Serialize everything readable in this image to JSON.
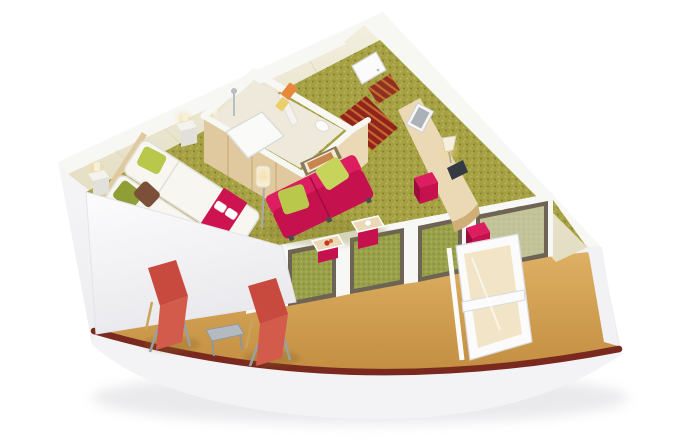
{
  "scene": {
    "kind": "isometric-3d-cutaway-floorplan",
    "description": "3D cutaway rendering of a wedge-shaped ship balcony suite on a white background: bedroom with twin beds, enclosed bathroom, entry hall with striped red runner, living area with magenta sofa and desk, and a curved private balcony with sun loungers",
    "rooms": [
      {
        "name": "bedroom",
        "items": [
          "twin-beds",
          "magenta-bed-runner",
          "folded-towels",
          "olive-pillow",
          "brown-pillow",
          "green-pillow",
          "nightstand-left",
          "nightstand-right",
          "bedside-lamps",
          "wall-sconces",
          "wardrobe"
        ]
      },
      {
        "name": "bathroom",
        "items": [
          "shower-tub",
          "shower-fixture",
          "partition-wall",
          "orange-towel",
          "yellow-towel",
          "wc"
        ]
      },
      {
        "name": "entry-hall",
        "items": [
          "entrance-door",
          "striped-runner-rug",
          "doorway-steps"
        ]
      },
      {
        "name": "living-area",
        "items": [
          "two-seat-magenta-sofa",
          "green-sofa-pillows",
          "art-above-sofa",
          "floor-lamp",
          "coffee-table-flower",
          "coffee-table-cup",
          "vanity-desk",
          "desk-lamp",
          "desk-mirror",
          "tv-screen",
          "magenta-ottoman-1",
          "magenta-ottoman-2",
          "art-right-wall",
          "right-wall-sconce"
        ]
      },
      {
        "name": "balcony",
        "items": [
          "sun-lounger-1",
          "sun-lounger-2",
          "side-table",
          "open-glass-door",
          "sliding-glass-wall",
          "dark-red-railing",
          "teak-deck"
        ]
      }
    ]
  },
  "colors": {
    "bg": "#ffffff",
    "shadow": "#d9d9de",
    "hullTop": "#fdfdfe",
    "hullBottom": "#e9e9ec",
    "fascia": "#f3f3f5",
    "wallCap": "#f7f7f4",
    "cream": "#f2eedd",
    "creamDark": "#e3ddc2",
    "creamLine": "#ddd6b8",
    "woodFace": "#e0c99e",
    "woodLight": "#ead9b4",
    "woodDark": "#cfae77",
    "woodLine": "#bf9a66",
    "carpet": "#a5a042",
    "carpetLight": "#bcb660",
    "carpetDark": "#837e30",
    "hallRed": "#8e241c",
    "hallStripe": "#c4682f",
    "hallEdge": "#b6b13e",
    "magenta": "#c6114f",
    "magentaBright": "#dc1e60",
    "magentaDark": "#9c0c3f",
    "pillowGreen": "#b9c84a",
    "pillowGreenLight": "#c7d45c",
    "pillowOlive": "#8f9e36",
    "pillowBrown": "#7c4f38",
    "bedWhite": "#f7f6f1",
    "bedShade": "#e1dfd4",
    "runner": "#ce1450",
    "towelOrange": "#e8883c",
    "towelYellow": "#ebcf6a",
    "tan": "#deb063",
    "tanDark": "#c38e41",
    "rail": "#7a291f",
    "loungerRed": "#c8493e",
    "loungerRedLight": "#d25b4b",
    "metal": "#98a0a6",
    "glassGreen": "#9aa14b",
    "glassGreenLight": "#b0b660",
    "glassGreenDark": "#7f842f",
    "glassFrame": "#6e6455",
    "mullion": "#f7f7f5",
    "doorWhite": "#fbfbfc",
    "doorGlass": "#e9cf92",
    "chrome": "#b9bec3",
    "glow": "#f7d98c",
    "lampWhite": "#f6efdc",
    "artFrame": "#8a7a5a",
    "artMat": "#f3ead6",
    "artOrange": "#c9854e",
    "tableGray": "#b3bac0",
    "tableGrayDark": "#8f979d",
    "bathFloor": "#efe9db",
    "mirrorGlass": "#d9d6c4",
    "white": "#ffffff"
  }
}
